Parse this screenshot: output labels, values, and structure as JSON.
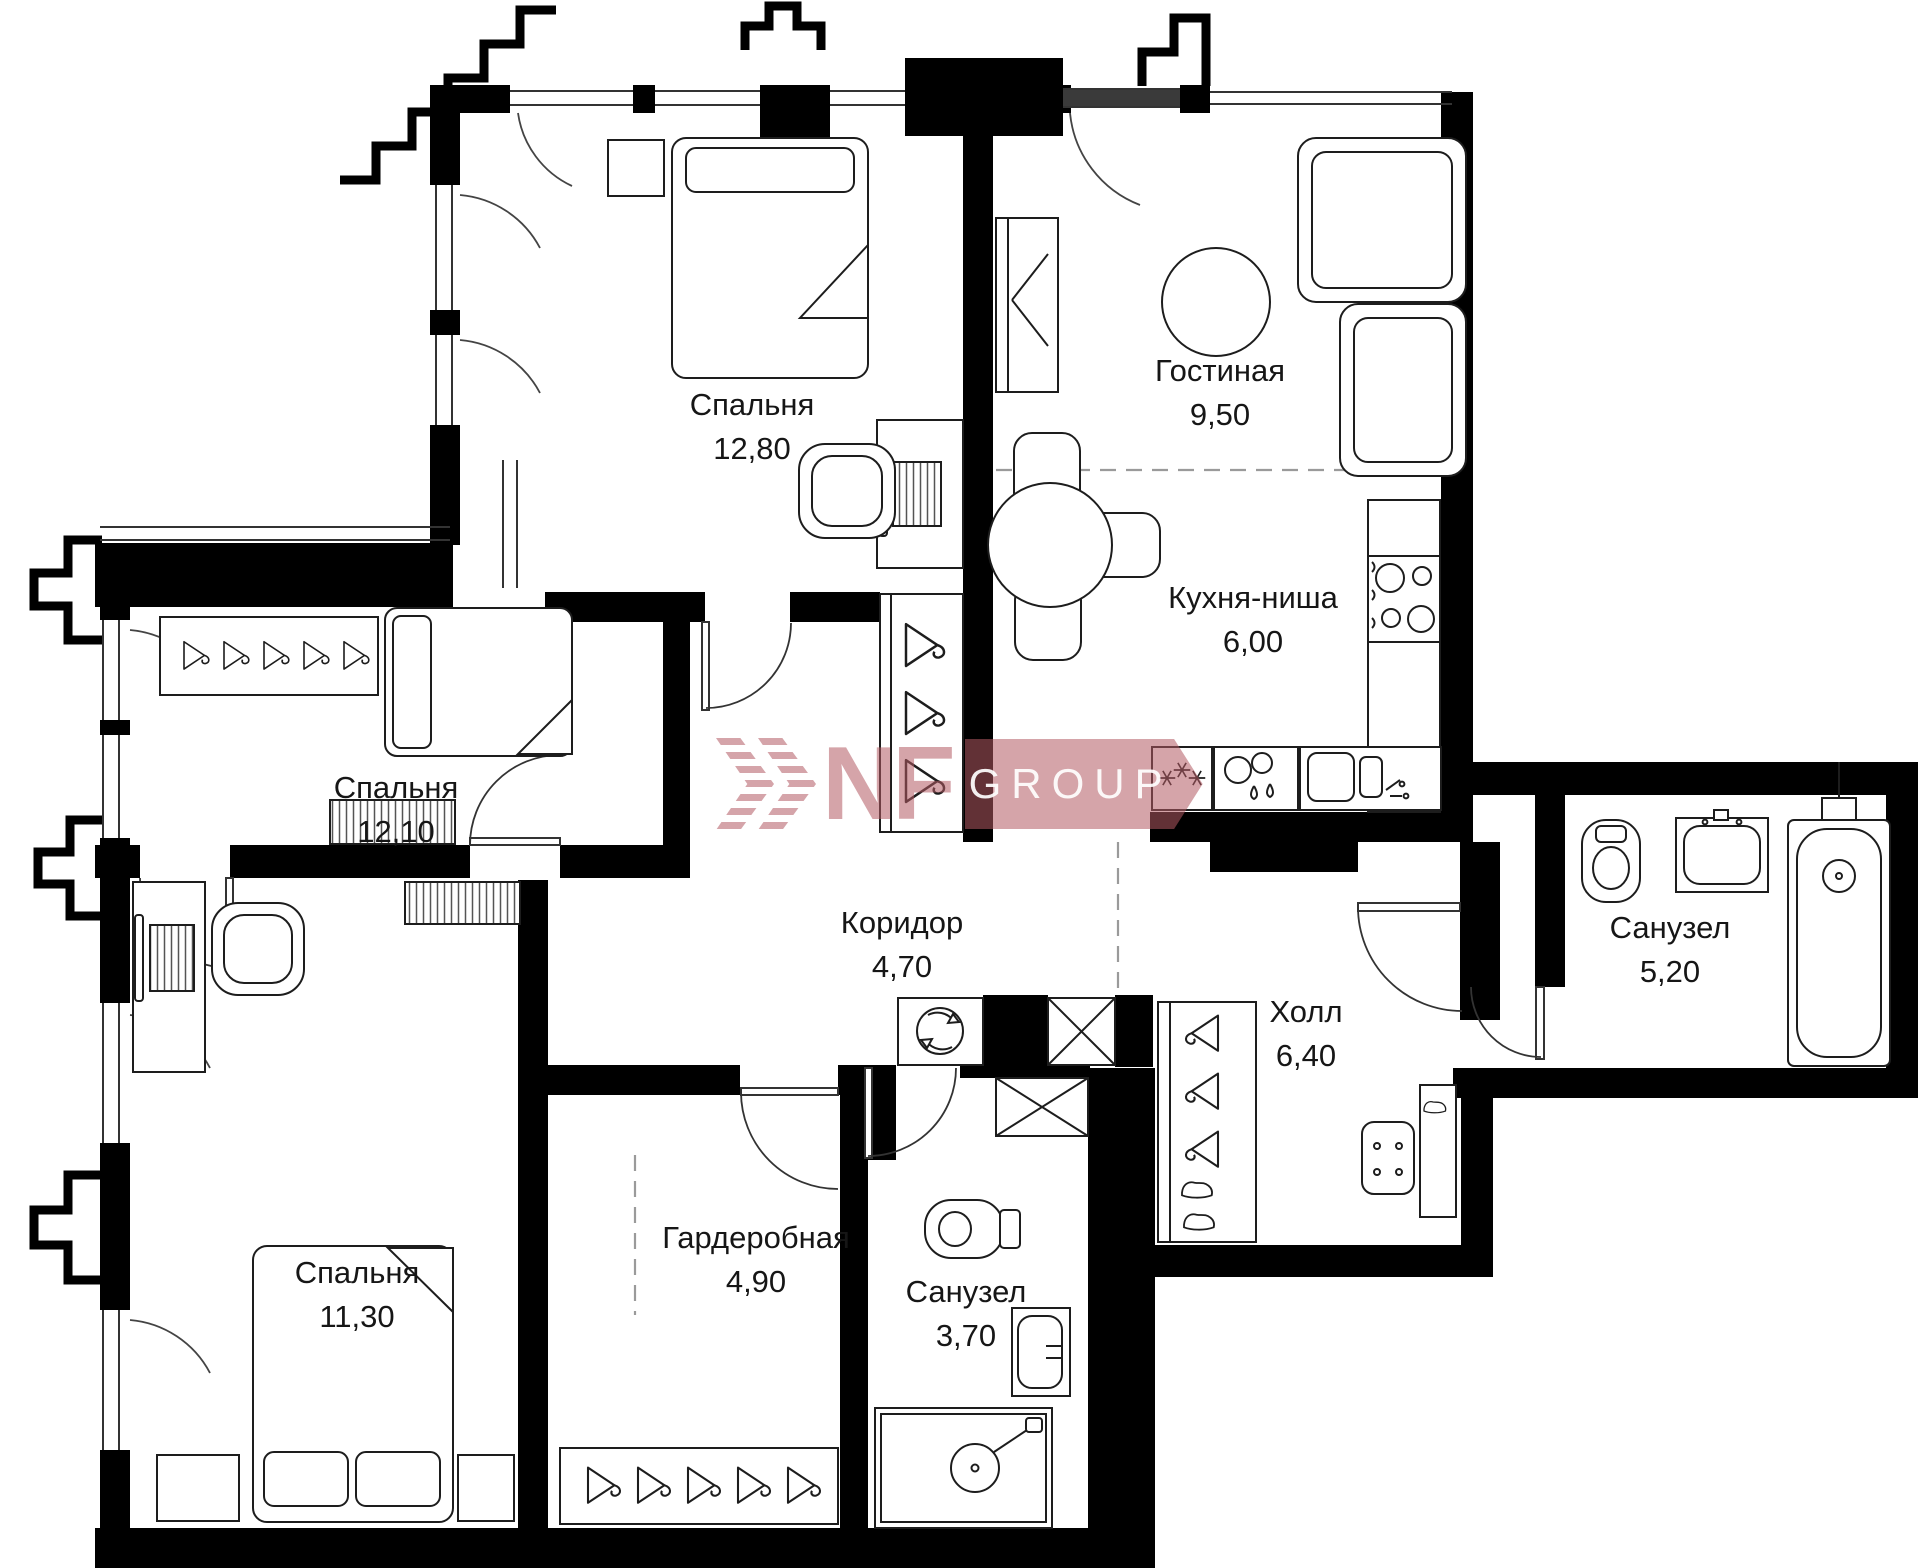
{
  "rooms": [
    {
      "name": "Спальня",
      "area": "12,80"
    },
    {
      "name": "Гостиная",
      "area": "9,50"
    },
    {
      "name": "Кухня-ниша",
      "area": "6,00"
    },
    {
      "name": "Спальня",
      "area": "12,10"
    },
    {
      "name": "Коридор",
      "area": "4,70"
    },
    {
      "name": "Холл",
      "area": "6,40"
    },
    {
      "name": "Санузел",
      "area": "5,20"
    },
    {
      "name": "Спальня",
      "area": "11,30"
    },
    {
      "name": "Гардеробная",
      "area": "4,90"
    },
    {
      "name": "Санузел",
      "area": "3,70"
    }
  ],
  "watermark": {
    "brand": "NF",
    "suffix": "GROUP",
    "color": "#b25a63"
  }
}
